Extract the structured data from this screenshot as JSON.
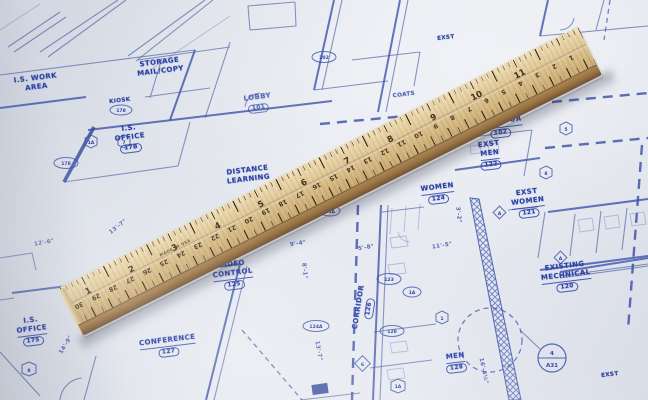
{
  "scene": {
    "description_colors": {
      "ink": "#2b41a6",
      "paper_light": "#e8ebf1",
      "paper_shade": "#cfd4df",
      "wood_light": "#f0e1bd",
      "wood_dark": "#c8a872"
    }
  },
  "ruler": {
    "inch_numbers": [
      "1",
      "2",
      "3",
      "4",
      "5",
      "6",
      "7",
      "8",
      "9",
      "10",
      "11"
    ],
    "cm_numbers": [
      "30",
      "29",
      "28",
      "27",
      "26",
      "25",
      "24",
      "23",
      "22",
      "21",
      "20",
      "19",
      "18",
      "17",
      "16",
      "15",
      "14",
      "13",
      "12",
      "11",
      "10",
      "9",
      "8",
      "7",
      "6",
      "5",
      "4",
      "3",
      "2",
      "1"
    ],
    "brand_text": "MADE IN USA"
  },
  "blueprint": {
    "labels": {
      "is_work_area": {
        "l1": "I.S. WORK",
        "l2": "AREA",
        "tag": "17B"
      },
      "storage": {
        "l1": "STORAGE",
        "l2": "MAIL/COPY",
        "tag": "178"
      },
      "kiosk": {
        "l1": "KIOSK"
      },
      "lobby": {
        "l1": "LOBBY",
        "tag": "101"
      },
      "is_office": {
        "l1": "I.S.",
        "l2": "OFFICE",
        "tag": "17B"
      },
      "coats": {
        "l1": "COATS"
      },
      "corridor_top": {
        "l1": "CORRIDOR",
        "tag": "102"
      },
      "exst_top": {
        "l1": "EXST"
      },
      "exst_men": {
        "l1": "EXST",
        "l2": "MEN",
        "tag": "122"
      },
      "exst_women": {
        "l1": "EXST",
        "l2": "WOMEN",
        "tag": "121"
      },
      "women_center": {
        "l1": "WOMEN",
        "tag": "124"
      },
      "distance_learning": {
        "l1": "DISTANCE",
        "l2": "LEARNING"
      },
      "video_control": {
        "l1": "VIDEO",
        "l2": "CONTROL",
        "tag": "125"
      },
      "conference": {
        "l1": "CONFERENCE",
        "tag": "127"
      },
      "is_office_175": {
        "l1": "I.S.",
        "l2": "OFFICE",
        "tag": "175"
      },
      "corridor_vert": {
        "l1": "CORRIDOR",
        "tag": "126"
      },
      "existing_mech": {
        "l1": "EXISTING",
        "l2": "MECHNICAL",
        "tag": "120"
      },
      "men": {
        "l1": "MEN",
        "tag": "128"
      },
      "exst_br": {
        "l1": "EXST"
      }
    },
    "tags": {
      "t202": "202",
      "t178": "178",
      "t123": "123",
      "t128": "128",
      "t14a": "14A",
      "t124a": "124A",
      "t1a": "1A",
      "h1": "1",
      "h1a": "1A",
      "h5": "5",
      "h8": "8",
      "h7": "7",
      "h8b": "8",
      "d6": "6",
      "a1": "A",
      "a2": "A",
      "a31_top": "4",
      "a31_bottom": "A31"
    },
    "dims": {
      "d1": "12'-6\"",
      "d2": "13'-7\"",
      "d3": "9'-4\"",
      "d4": "8'-1\"",
      "d5": "13'-7\"",
      "d6": "14'-9\"",
      "d7": "11'-5\"",
      "d8": "5'-8\"",
      "d9": "16'-4½\"",
      "d10": "3'-2\""
    }
  }
}
